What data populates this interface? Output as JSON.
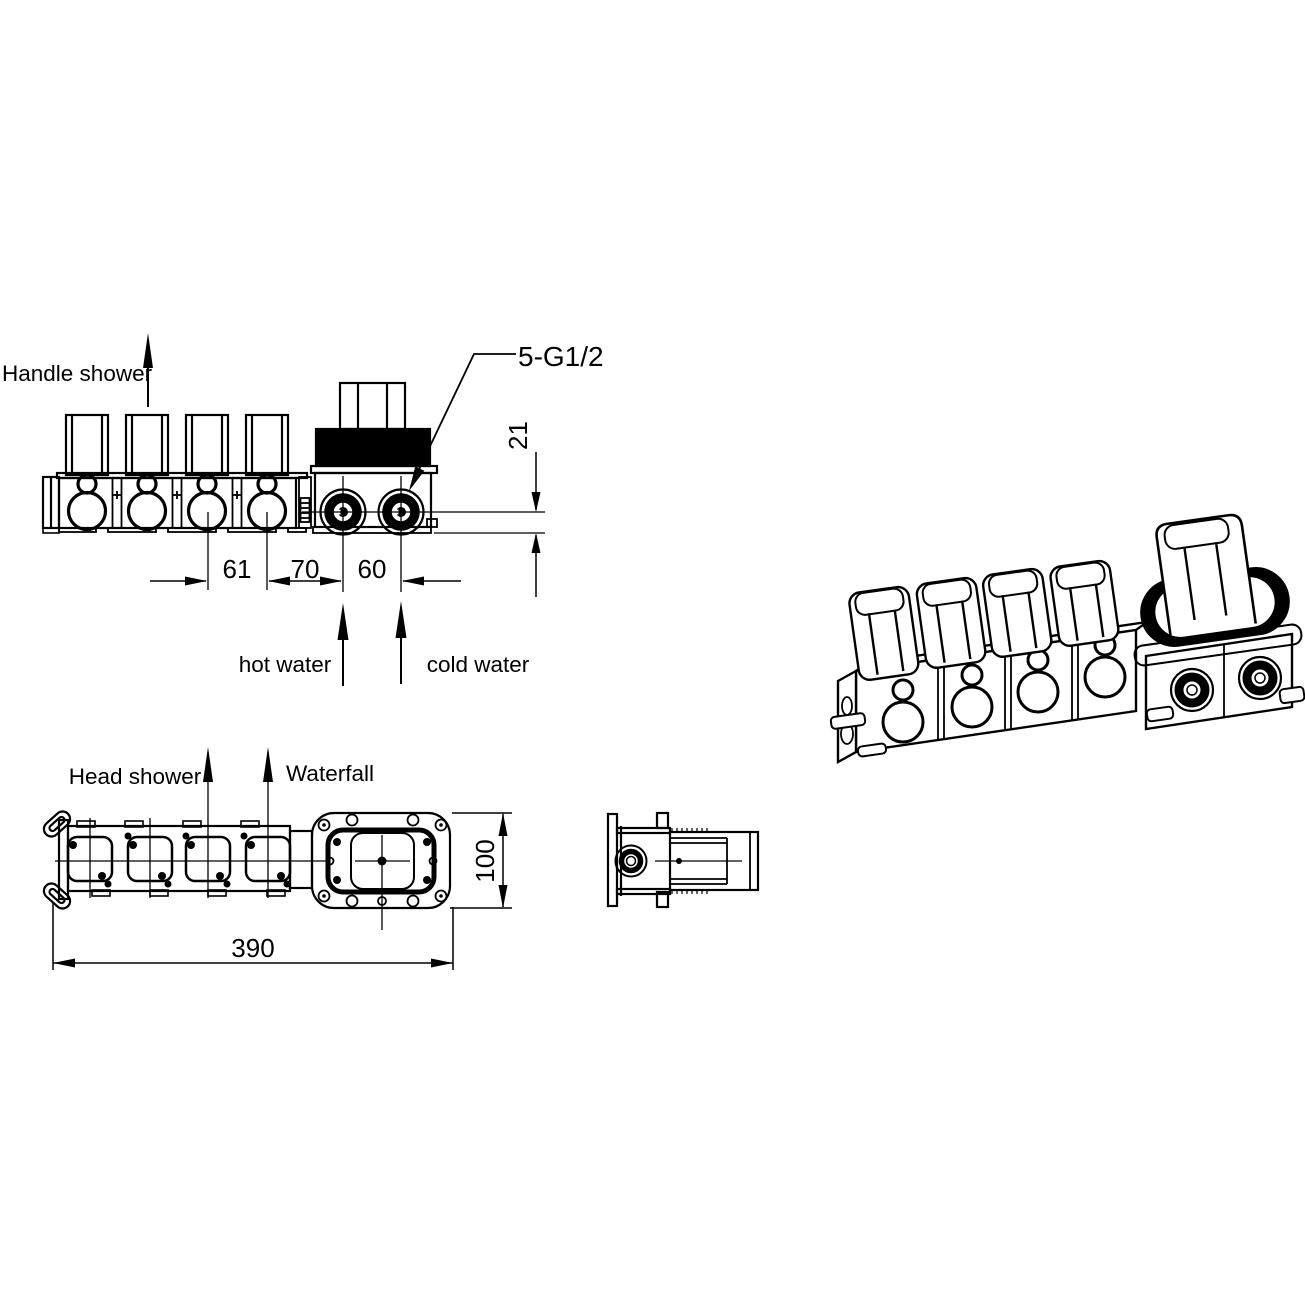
{
  "colors": {
    "ink": "#000000",
    "paper": "#ffffff"
  },
  "front_view": {
    "handle_shower_label": "Handle shower",
    "thread_spec_label": "5-G1/2",
    "hot_water_label": "hot water",
    "cold_water_label": "cold water",
    "dim_valve_spacing": "61",
    "dim_valve_to_hot": "70",
    "dim_hot_to_cold": "60",
    "dim_port_offset": "21"
  },
  "top_view": {
    "head_shower_label": "Head shower",
    "waterfall_label": "Waterfall",
    "dim_overall_length": "390",
    "dim_body_width": "100"
  }
}
